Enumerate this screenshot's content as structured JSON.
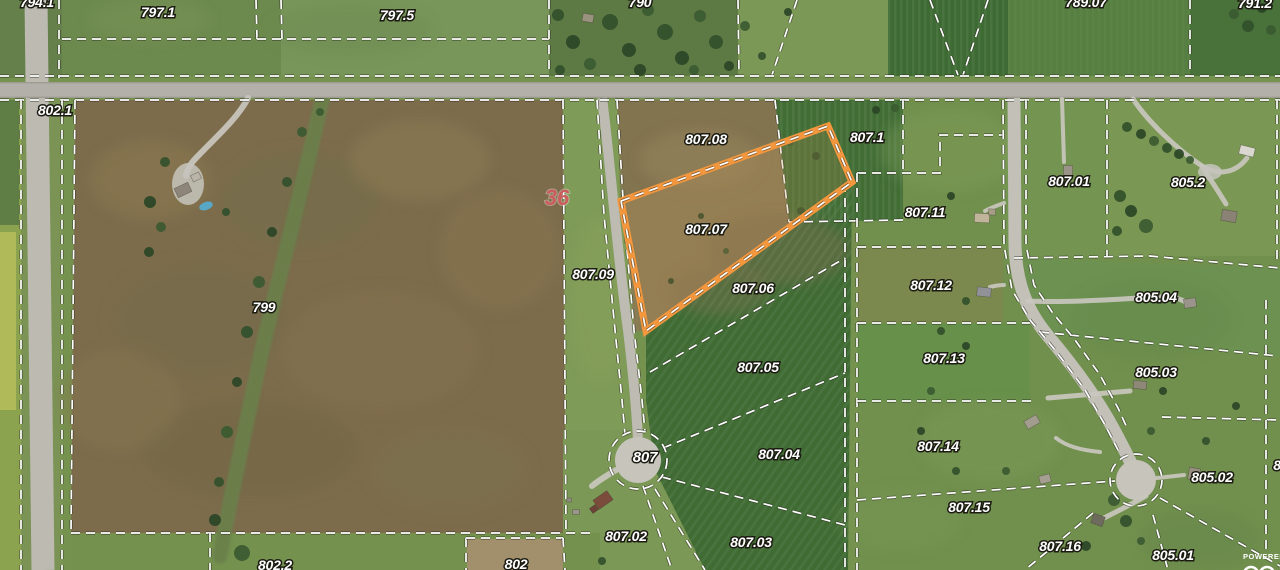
{
  "map": {
    "attribution": "POWERED",
    "section_marker": {
      "label": "36",
      "x": 557,
      "y": 205,
      "color": "#cd5c5c"
    },
    "highlight": {
      "parcel": "807.07",
      "color": "#f2973d",
      "points": "621,201 828,126 852,182 646,331"
    },
    "parcel_labels": [
      {
        "label": "794.1",
        "x": 37,
        "y": 7
      },
      {
        "label": "797.1",
        "x": 158,
        "y": 17
      },
      {
        "label": "797.5",
        "x": 397,
        "y": 20
      },
      {
        "label": "790",
        "x": 640,
        "y": 7
      },
      {
        "label": "789.07",
        "x": 1086,
        "y": 7
      },
      {
        "label": "791.2",
        "x": 1255,
        "y": 8
      },
      {
        "label": "802.1",
        "x": 55,
        "y": 115
      },
      {
        "label": "799",
        "x": 264,
        "y": 312
      },
      {
        "label": "802.2",
        "x": 275,
        "y": 570
      },
      {
        "label": "802",
        "x": 516,
        "y": 569
      },
      {
        "label": "807.08",
        "x": 706,
        "y": 144
      },
      {
        "label": "807.07",
        "x": 706,
        "y": 234
      },
      {
        "label": "807.09",
        "x": 593,
        "y": 279
      },
      {
        "label": "807.06",
        "x": 753,
        "y": 293
      },
      {
        "label": "807.05",
        "x": 758,
        "y": 372
      },
      {
        "label": "807",
        "x": 645,
        "y": 462,
        "size": "big"
      },
      {
        "label": "807.04",
        "x": 779,
        "y": 459
      },
      {
        "label": "807.02",
        "x": 626,
        "y": 541
      },
      {
        "label": "807.03",
        "x": 751,
        "y": 547
      },
      {
        "label": "807.1",
        "x": 867,
        "y": 142
      },
      {
        "label": "807.11",
        "x": 925,
        "y": 217
      },
      {
        "label": "807.12",
        "x": 931,
        "y": 290
      },
      {
        "label": "807.13",
        "x": 944,
        "y": 363
      },
      {
        "label": "807.14",
        "x": 938,
        "y": 451
      },
      {
        "label": "807.15",
        "x": 969,
        "y": 512
      },
      {
        "label": "807.16",
        "x": 1060,
        "y": 551
      },
      {
        "label": "807.01",
        "x": 1069,
        "y": 186
      },
      {
        "label": "805.2",
        "x": 1188,
        "y": 187
      },
      {
        "label": "805.04",
        "x": 1156,
        "y": 302
      },
      {
        "label": "805.03",
        "x": 1156,
        "y": 377
      },
      {
        "label": "805.02",
        "x": 1212,
        "y": 482
      },
      {
        "label": "805.01",
        "x": 1173,
        "y": 560
      },
      {
        "label": "8",
        "x": 1277,
        "y": 470
      }
    ],
    "fields": [
      {
        "r": [
          0,
          0,
          1280,
          570
        ],
        "f": "#76924f"
      },
      {
        "r": [
          0,
          0,
          62,
          78
        ],
        "f": "#65804a"
      },
      {
        "r": [
          62,
          0,
          219,
          76
        ],
        "f": "#6d8a4e"
      },
      {
        "r": [
          281,
          0,
          268,
          76
        ],
        "f": "#78955a"
      },
      {
        "r": [
          549,
          0,
          189,
          76
        ],
        "f": "#5d7a44"
      },
      {
        "r": [
          738,
          0,
          150,
          76
        ],
        "f": "#7c9857"
      },
      {
        "r": [
          888,
          0,
          120,
          76
        ],
        "f": "#3e6b33"
      },
      {
        "r": [
          1008,
          0,
          182,
          76
        ],
        "f": "#567f41"
      },
      {
        "r": [
          1190,
          0,
          90,
          76
        ],
        "f": "#49713a"
      },
      {
        "r": [
          0,
          100,
          21,
          470
        ],
        "f": "#8ba24f"
      },
      {
        "r": [
          0,
          100,
          19,
          125
        ],
        "f": "#5f7e46"
      },
      {
        "r": [
          0,
          232,
          16,
          178
        ],
        "f": "#b1ba58"
      },
      {
        "r": [
          21,
          100,
          41,
          470
        ],
        "f": "#7b9355"
      },
      {
        "p": "75,100 563,100 566,533 71,533",
        "f": "#7d6c4c"
      },
      {
        "p": "563,100 617,100 624,215 634,330 645,440 625,462 566,533",
        "f": "#7f9b58"
      },
      {
        "p": "563,430 662,430 707,570 563,570",
        "f": "#7c9856"
      },
      {
        "r": [
          71,
          533,
          529,
          37
        ],
        "f": "#74914e"
      },
      {
        "r": [
          467,
          539,
          96,
          31
        ],
        "f": "#a28f6b"
      },
      {
        "p": "617,100 775,100 830,127 852,182 646,331 634,331 624,215",
        "f": "#8a7b55"
      },
      {
        "p": "617,100 775,100 818,124 620,199",
        "f": "#7b6e4b",
        "o": 0.5
      },
      {
        "r": [
          857,
          100,
          423,
          470
        ],
        "f": "#71904e"
      },
      {
        "p": "852,182 848,570 705,570 655,470 646,400 646,331",
        "f": "#406c34"
      },
      {
        "p": "775,100 903,100 903,220 789,222",
        "f": "#426e36"
      },
      {
        "r": [
          857,
          247,
          146,
          76
        ],
        "f": "#7b894f"
      },
      {
        "r": [
          857,
          323,
          173,
          78
        ],
        "f": "#67904a"
      },
      {
        "p": "1014,258 1280,268 1280,356 1048,336",
        "f": "#6d9150"
      },
      {
        "r": [
          1107,
          100,
          173,
          156
        ],
        "f": "#7a9754"
      },
      {
        "r": [
          1003,
          100,
          104,
          156
        ],
        "f": "#749552"
      }
    ],
    "stripe_overlays": [
      {
        "r": [
          888,
          0,
          120,
          76
        ],
        "pat": "vstripe"
      },
      {
        "p": "852,182 848,570 705,570 655,470 646,400 646,331",
        "pat": "dstripe"
      },
      {
        "p": "775,100 903,100 903,220 789,222",
        "pat": "vstripe"
      },
      {
        "r": [
          1008,
          0,
          182,
          76
        ],
        "pat": "vstripe",
        "o": 0.5
      }
    ],
    "mottle": [
      [
        150,
        180,
        60,
        40,
        "#8c7950",
        0.5
      ],
      [
        300,
        200,
        80,
        50,
        "#6f6f49",
        0.4
      ],
      [
        420,
        160,
        70,
        40,
        "#8e7c53",
        0.5
      ],
      [
        200,
        320,
        90,
        60,
        "#746a49",
        0.45
      ],
      [
        380,
        350,
        100,
        60,
        "#837150",
        0.5
      ],
      [
        250,
        450,
        110,
        50,
        "#6d6847",
        0.4
      ],
      [
        450,
        470,
        80,
        45,
        "#7d7050",
        0.5
      ],
      [
        120,
        400,
        60,
        50,
        "#877550",
        0.45
      ],
      [
        500,
        250,
        60,
        60,
        "#8a7850",
        0.4
      ],
      [
        700,
        160,
        60,
        30,
        "#96855c",
        0.5
      ],
      [
        780,
        250,
        70,
        35,
        "#7b6f4e",
        0.45
      ],
      [
        720,
        290,
        50,
        25,
        "#7d7350",
        0.4
      ],
      [
        950,
        150,
        70,
        40,
        "#84a15c",
        0.35
      ],
      [
        1150,
        320,
        80,
        40,
        "#618544",
        0.3
      ],
      [
        990,
        440,
        70,
        40,
        "#7e9c58",
        0.35
      ],
      [
        600,
        300,
        30,
        80,
        "#8aa45e",
        0.3
      ],
      [
        350,
        30,
        80,
        25,
        "#6b8a4e",
        0.4
      ],
      [
        150,
        20,
        60,
        20,
        "#7d9558",
        0.35
      ],
      [
        1200,
        540,
        60,
        30,
        "#628547",
        0.35
      ],
      [
        900,
        520,
        60,
        30,
        "#7b9a55",
        0.3
      ]
    ],
    "streams": [
      {
        "d": "M322,100 C302,190 278,280 262,350 C247,420 232,490 220,556",
        "s": "#69814a",
        "w": 15,
        "o": 0.9
      }
    ],
    "roads": {
      "main": {
        "r": [
          0,
          82,
          1280,
          16
        ],
        "f": "#b2b0a8"
      },
      "main_edges": [
        [
          0,
          82,
          1280,
          1.4
        ],
        [
          0,
          96.6,
          1280,
          1.4
        ]
      ],
      "edge_color": "#98968d",
      "paths": [
        {
          "d": "M36,0 L43,570",
          "s": "#bcbab1",
          "w": 23
        },
        {
          "d": "M602,98 C610,160 618,260 628,330 C634,380 637,420 638,440",
          "s": "#bdbbb2",
          "w": 10
        },
        {
          "d": "M1014,98 L1015,245 C1016,285 1028,312 1048,336 C1075,368 1098,400 1114,430 C1122,445 1130,460 1133,468",
          "s": "#c2c0b7",
          "w": 13
        }
      ],
      "bulbs": [
        [
          638,
          460,
          23
        ],
        [
          1136,
          480,
          20
        ]
      ],
      "bulb_color": "#c6c4bb"
    },
    "driveways": [
      {
        "d": "M248,98 C238,118 215,138 196,158 C190,164 187,170 186,176",
        "w": 6
      },
      {
        "d": "M1004,203 C996,206 990,208 985,211",
        "w": 4
      },
      {
        "d": "M1004,285 C998,285 994,286 990,287",
        "w": 4
      },
      {
        "d": "M1062,99 L1064,162",
        "w": 4
      },
      {
        "d": "M1133,99 C1148,122 1178,150 1202,166 C1222,178 1238,170 1247,158",
        "w": 5
      },
      {
        "d": "M1202,166 C1212,182 1220,194 1226,204",
        "w": 5
      },
      {
        "d": "M1028,301 C1070,303 1120,299 1158,297 C1172,296 1182,299 1188,304",
        "w": 5
      },
      {
        "d": "M1048,398 L1130,391",
        "w": 5
      },
      {
        "d": "M1157,478 L1184,475",
        "w": 4
      },
      {
        "d": "M1100,452 C1080,450 1066,446 1056,438",
        "w": 4
      },
      {
        "d": "M1146,496 C1128,506 1112,514 1102,519",
        "w": 5
      },
      {
        "d": "M616,470 C606,476 598,481 592,486",
        "w": 6
      }
    ],
    "pads": [
      [
        188,
        184,
        16,
        21
      ],
      [
        1210,
        172,
        12,
        8
      ]
    ],
    "houses": [
      [
        183,
        190,
        15,
        10,
        -25,
        "#8d8579"
      ],
      [
        196,
        177,
        9,
        7,
        -25,
        "#b9b4a7"
      ],
      [
        588,
        18,
        11,
        8,
        10,
        "#98927f"
      ],
      [
        603,
        500,
        17,
        11,
        -35,
        "#7b4c3c"
      ],
      [
        594,
        509,
        7,
        6,
        -35,
        "#6d4237"
      ],
      [
        982,
        218,
        15,
        9,
        3,
        "#c0b49b"
      ],
      [
        992,
        212,
        7,
        6,
        3,
        "#a89d87"
      ],
      [
        984,
        292,
        14,
        9,
        6,
        "#8f9297"
      ],
      [
        1068,
        172,
        9,
        13,
        2,
        "#9a9488"
      ],
      [
        1247,
        151,
        15,
        9,
        14,
        "#d9d7cf"
      ],
      [
        1229,
        216,
        15,
        11,
        10,
        "#8a8274"
      ],
      [
        1190,
        303,
        12,
        9,
        -8,
        "#9b948a"
      ],
      [
        1140,
        385,
        13,
        8,
        5,
        "#8e8878"
      ],
      [
        1032,
        422,
        14,
        9,
        -30,
        "#a29c8e"
      ],
      [
        1194,
        474,
        11,
        12,
        10,
        "#968e7e"
      ],
      [
        1098,
        520,
        12,
        10,
        20,
        "#6f6a5e"
      ],
      [
        1045,
        479,
        11,
        8,
        -15,
        "#a59f92"
      ],
      [
        576,
        512,
        7,
        5,
        0,
        "#9a958a"
      ],
      [
        569,
        500,
        5,
        4,
        0,
        "#8f8a80"
      ]
    ],
    "pool": [
      206,
      206,
      7,
      4,
      -20,
      "#58a7c6"
    ],
    "trees": [
      [
        558,
        15,
        6
      ],
      [
        573,
        42,
        7
      ],
      [
        590,
        64,
        6
      ],
      [
        610,
        22,
        8
      ],
      [
        629,
        50,
        7
      ],
      [
        648,
        10,
        6
      ],
      [
        665,
        32,
        8
      ],
      [
        682,
        58,
        7
      ],
      [
        700,
        16,
        6
      ],
      [
        716,
        42,
        7
      ],
      [
        729,
        66,
        5
      ],
      [
        694,
        70,
        5
      ],
      [
        560,
        70,
        5
      ],
      [
        640,
        70,
        6
      ],
      [
        745,
        26,
        5
      ],
      [
        762,
        56,
        4
      ],
      [
        788,
        12,
        4
      ],
      [
        1234,
        14,
        5
      ],
      [
        1248,
        26,
        6
      ],
      [
        1262,
        8,
        5
      ],
      [
        1271,
        30,
        5
      ],
      [
        1127,
        127,
        5
      ],
      [
        1141,
        134,
        5
      ],
      [
        1154,
        141,
        5
      ],
      [
        1167,
        148,
        5
      ],
      [
        1179,
        154,
        5
      ],
      [
        1190,
        160,
        4
      ],
      [
        1120,
        196,
        6
      ],
      [
        1131,
        211,
        6
      ],
      [
        1146,
        226,
        7
      ],
      [
        1117,
        231,
        5
      ],
      [
        1163,
        391,
        4
      ],
      [
        1151,
        431,
        4
      ],
      [
        1206,
        441,
        4
      ],
      [
        1236,
        406,
        4
      ],
      [
        1114,
        500,
        6
      ],
      [
        1126,
        521,
        6
      ],
      [
        1086,
        546,
        5
      ],
      [
        1141,
        541,
        4
      ],
      [
        941,
        331,
        4
      ],
      [
        966,
        346,
        4
      ],
      [
        931,
        391,
        4
      ],
      [
        956,
        471,
        4
      ],
      [
        921,
        431,
        4
      ],
      [
        1006,
        471,
        4
      ],
      [
        966,
        301,
        4
      ],
      [
        951,
        196,
        4
      ],
      [
        302,
        132,
        5
      ],
      [
        287,
        182,
        5
      ],
      [
        272,
        232,
        5
      ],
      [
        259,
        282,
        6
      ],
      [
        247,
        332,
        6
      ],
      [
        237,
        382,
        5
      ],
      [
        227,
        432,
        6
      ],
      [
        219,
        482,
        5
      ],
      [
        215,
        520,
        6
      ],
      [
        320,
        112,
        4
      ],
      [
        165,
        162,
        5
      ],
      [
        150,
        202,
        6
      ],
      [
        161,
        227,
        5
      ],
      [
        226,
        212,
        4
      ],
      [
        149,
        252,
        5
      ],
      [
        790,
        142,
        4
      ],
      [
        816,
        156,
        4
      ],
      [
        701,
        216,
        3
      ],
      [
        726,
        251,
        3
      ],
      [
        801,
        211,
        4
      ],
      [
        671,
        281,
        3
      ],
      [
        242,
        553,
        8
      ],
      [
        602,
        561,
        4
      ],
      [
        876,
        110,
        4
      ],
      [
        895,
        108,
        4
      ]
    ],
    "boundaries": [
      "59,0 59,78",
      "256,0 257,39",
      "281,0 282,39",
      "62,39 549,39",
      "549,0 549,75",
      "738,0 739,75",
      "797,0 772,75",
      "930,0 958,75",
      "988,0 963,75",
      "1190,0 1190,75",
      "0,76 1280,76",
      "0,100 1280,100",
      "21,100 21,570",
      "62,100 62,570",
      "75,100 71,533",
      "71,533 590,533",
      "210,533 210,570",
      "466,538 466,570",
      "466,538 563,538",
      "563,538 565,570",
      "597,100 604,215 615,330 622,400 625,435",
      "617,100 624,215 634,330 642,400 645,432",
      "563,100 566,533",
      "775,100 789,222",
      "789,222 903,220",
      "903,100 903,173",
      "857,173 940,173 940,135 1003,135",
      "845,183 845,570",
      "857,173 857,570",
      "857,247 1003,247",
      "857,323 1030,323",
      "857,401 1033,401",
      "857,500 1115,481",
      "1093,513 1025,570",
      "1153,515 1168,570",
      "1160,498 1280,566",
      "1162,417 1280,420",
      "1040,332 1278,356",
      "1014,258 1150,256 1280,268",
      "1107,100 1107,256",
      "1277,100 1277,260",
      "1266,300 1266,552",
      "1003,100 1004,245 1012,290 1030,320 1055,350 1085,390 1105,425 1118,450",
      "1026,100 1026,245 1034,285 1052,312 1075,340 1100,375 1118,408 1128,430",
      "662,477 845,525",
      "663,448 845,373",
      "650,372 845,258",
      "643,486 672,570",
      "655,489 705,570"
    ],
    "rings": [
      [
        638,
        460,
        29
      ],
      [
        1136,
        480,
        26
      ]
    ],
    "logo_rings": [
      [
        1251,
        574,
        7
      ],
      [
        1267,
        574,
        7
      ]
    ],
    "attribution_pos": [
      1243,
      559
    ]
  }
}
